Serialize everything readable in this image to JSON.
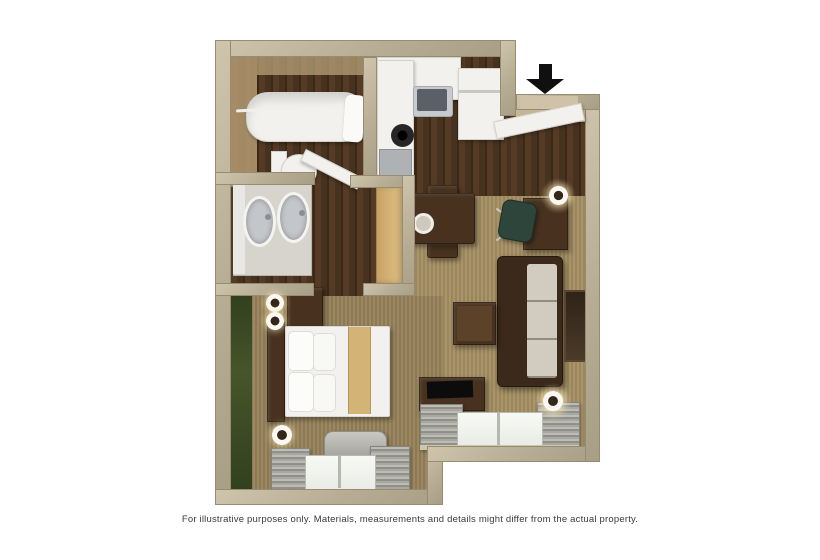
{
  "image": {
    "type": "3d-floor-plan-render",
    "disclaimer": "For illustrative purposes only.  Materials, measurements and details might differ from the actual property.",
    "entrance": {
      "icon": "black-down-arrow",
      "location": "top-right-above-door"
    }
  },
  "palette": {
    "background": "#ffffff",
    "wall_beige": "#b7ad94",
    "wood_floor_dark": "#46321e",
    "living_carpet": "#a58f63",
    "bedroom_carpet": "#96825a",
    "accent_wall_green": "#3c4a24",
    "counter_white": "#f2f1ee",
    "closet_wood": "#ddbb80",
    "sofa_frame_brown": "#3b2a1b",
    "sofa_cushion": "#cfc8bc",
    "dark_wood_furniture": "#48321f",
    "bedding_white": "#f2f1ef",
    "bed_runner_gold": "#d4b377",
    "desk_chair_teal": "#2d453b",
    "curtain_gray": "#a5a59d",
    "window_glass": "#f2f4ef",
    "appliance_gray": "#b6b4af",
    "arrow_black": "#101010"
  }
}
